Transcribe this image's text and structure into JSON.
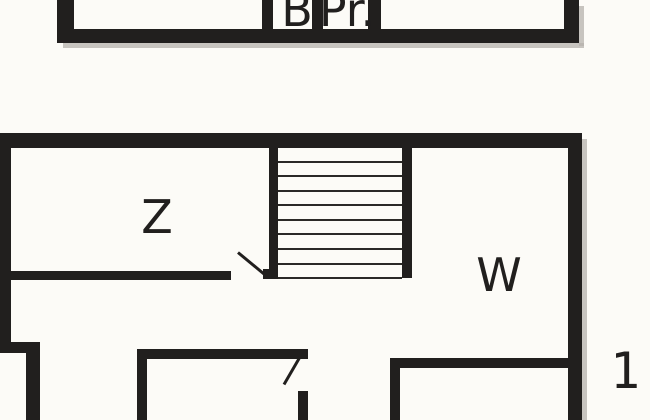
{
  "plans": {
    "upper": {
      "name": "upper-floor-strip",
      "rooms": [
        {
          "label": "B"
        },
        {
          "label": "Pr."
        }
      ]
    },
    "lower": {
      "name": "main-floor",
      "rooms": [
        {
          "label": "Z"
        },
        {
          "label": "W"
        }
      ],
      "stairs": {
        "steps": 9
      },
      "floor_label": "1."
    }
  },
  "colors": {
    "wall": "#211f1e",
    "background": "#fcfbf7",
    "shadow": "#b5b2ac",
    "tread": "#2b2927"
  }
}
